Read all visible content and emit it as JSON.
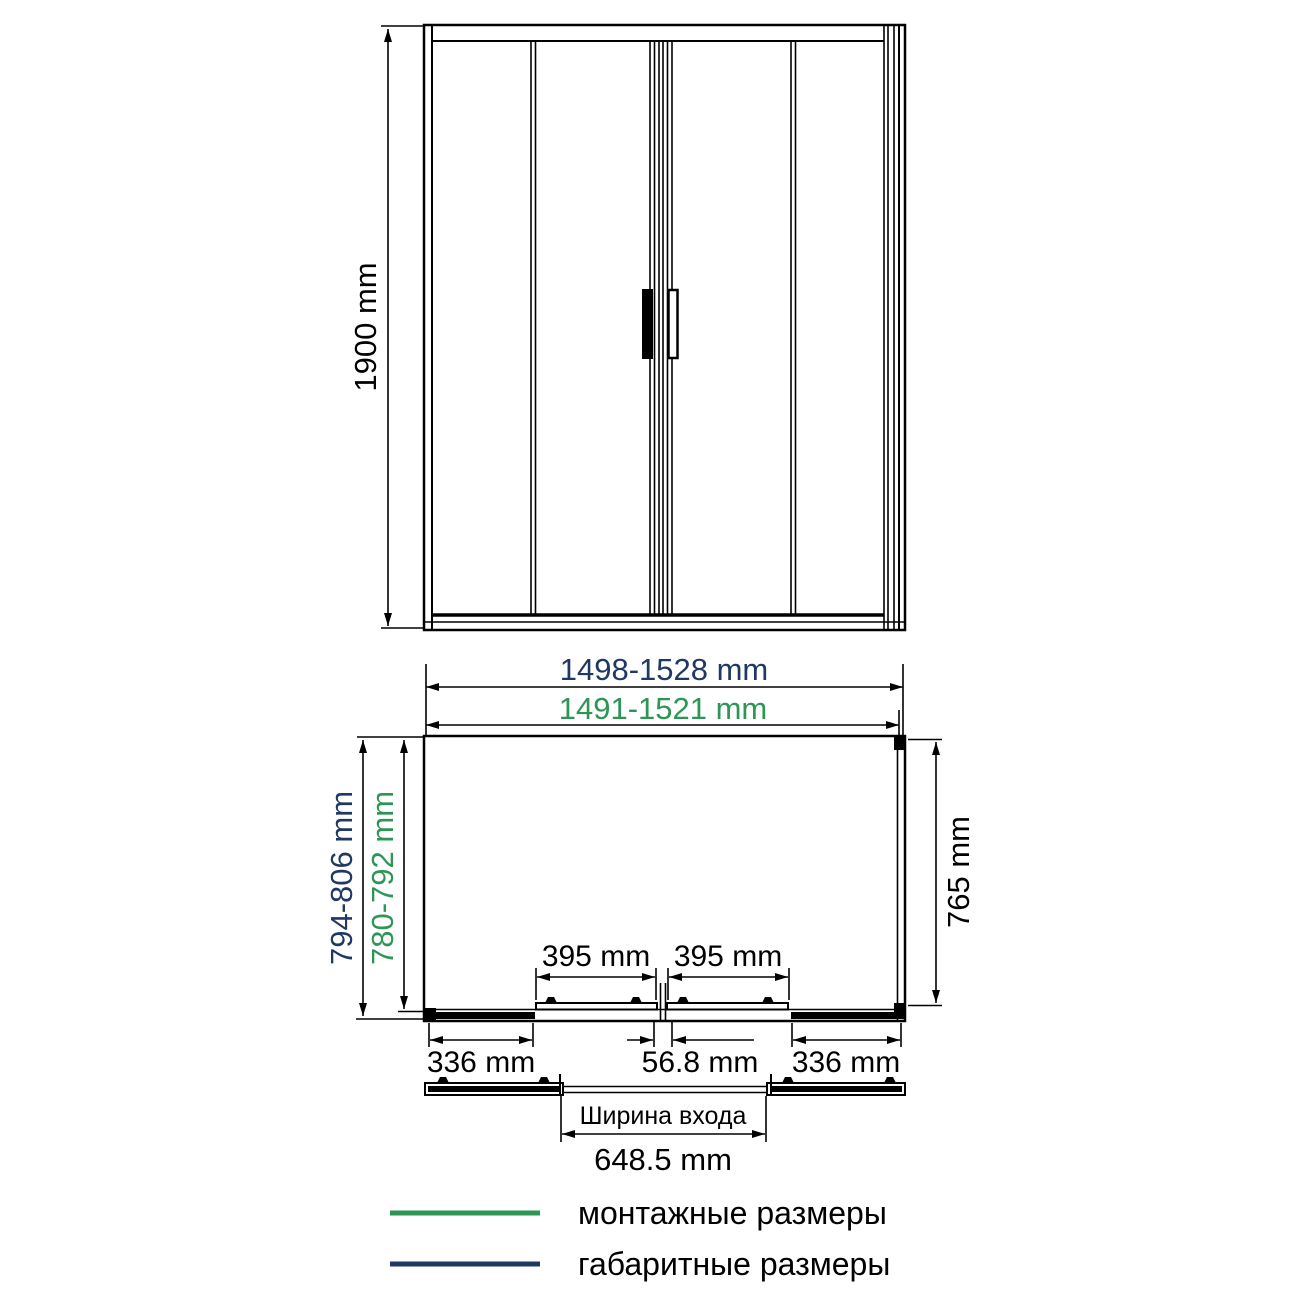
{
  "colors": {
    "mounting_green": "#2e9655",
    "overall_navy": "#1f3864",
    "line_black": "#000000"
  },
  "front_view": {
    "height_label": "1900 mm"
  },
  "plan_view": {
    "overall_width_label": "1498-1528 mm",
    "mounting_width_label": "1491-1521 mm",
    "overall_depth_label": "794-806 mm",
    "mounting_depth_label": "780-792 mm",
    "inner_depth_label": "765 mm",
    "left_door_width_label": "395 mm",
    "right_door_width_label": "395 mm",
    "left_fixed_panel_label": "336 mm",
    "center_overlap_label": "56.8 mm",
    "right_fixed_panel_label": "336 mm"
  },
  "entrance": {
    "caption": "Ширина входа",
    "width_label": "648.5 mm"
  },
  "legend": {
    "mounting_label": "монтажные размеры",
    "overall_label": "габаритные размеры"
  }
}
